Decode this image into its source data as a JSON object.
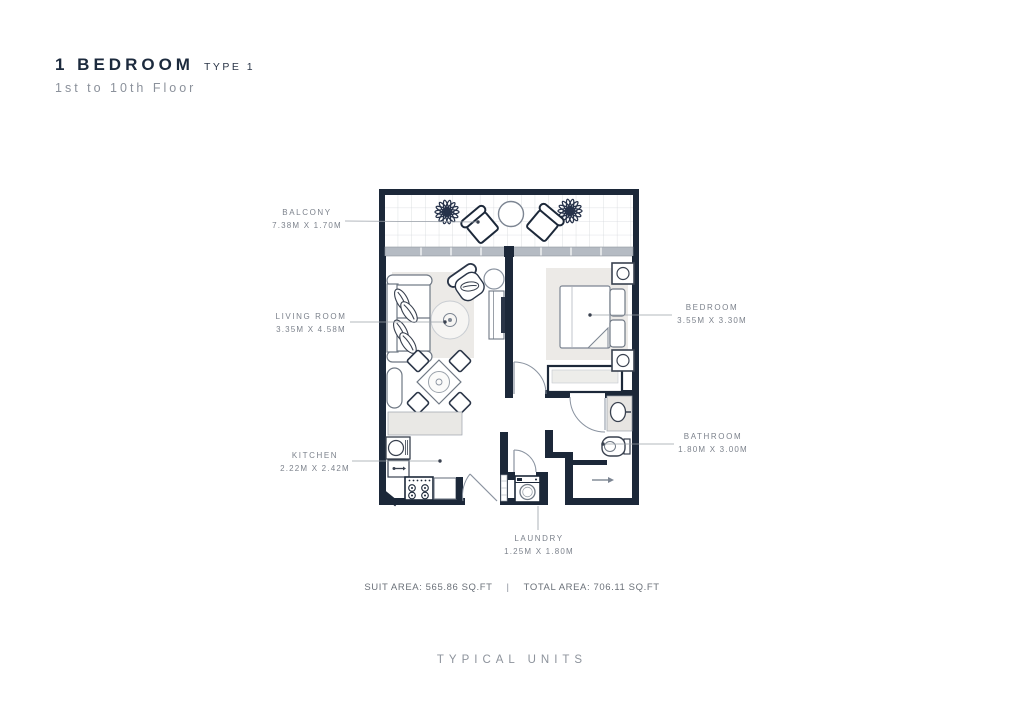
{
  "header": {
    "title": "1 BEDROOM",
    "type_label": "TYPE 1",
    "subtitle": "1st to 10th Floor"
  },
  "rooms": {
    "balcony": {
      "label": "BALCONY",
      "dims": "7.38M X 1.70M"
    },
    "living_room": {
      "label": "LIVING ROOM",
      "dims": "3.35M X 4.58M"
    },
    "bedroom": {
      "label": "BEDROOM",
      "dims": "3.55M X 3.30M"
    },
    "kitchen": {
      "label": "KITCHEN",
      "dims": "2.22M X 2.42M"
    },
    "bathroom": {
      "label": "BATHROOM",
      "dims": "1.80M X 3.00M"
    },
    "laundry": {
      "label": "LAUNDRY",
      "dims": "1.25M X 1.80M"
    }
  },
  "areas": {
    "suit": "SUIT AREA: 565.86 SQ.FT",
    "divider": "|",
    "total": "TOTAL AREA: 706.11 SQ.FT"
  },
  "footer": {
    "label": "TYPICAL UNITS"
  },
  "colors": {
    "wall": "#1c2839",
    "furniture_dark": "#39414f",
    "furniture_light": "#6f7884",
    "rug": "#eceae7",
    "window_band": "#b5bbc3",
    "leader": "#9aa0a8",
    "title": "#1c2a3d",
    "text_muted": "#7c828c"
  }
}
